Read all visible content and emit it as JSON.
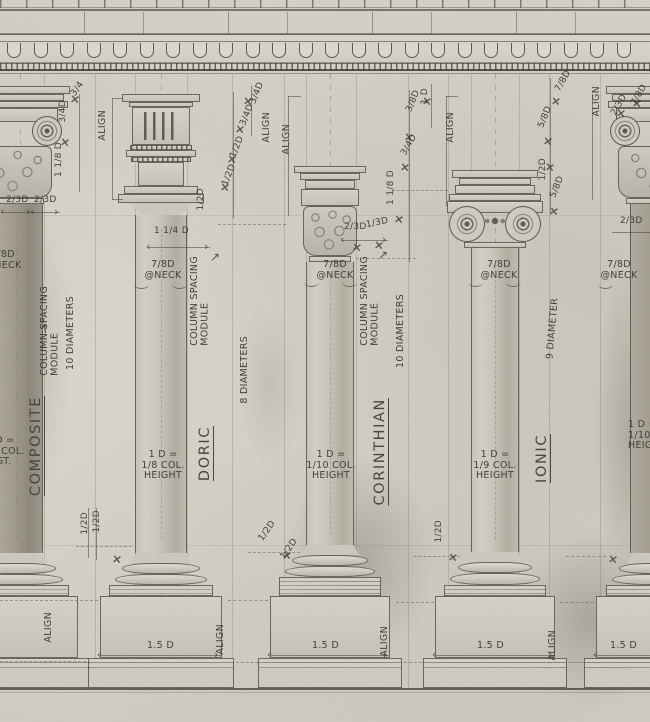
{
  "meta": {
    "subject": "Hand-drawn classical column orders elevation"
  },
  "colors": {
    "paper": "#d4d1c7",
    "ink": "#4a463e",
    "pencil": "#6a655a"
  },
  "orders": {
    "composite": {
      "name": "COMPOSITE",
      "module": "COLUMN SPACING\nMODULE",
      "diameters": "10 DIAMETERS",
      "neck": "7/8D\n@NECK",
      "height_rule": "1 D =\n1/10 COL.\nHGT."
    },
    "doric": {
      "name": "DORIC",
      "module": "COLUMN SPACING\nMODULE",
      "diameters": "8 DIAMETERS",
      "neck": "7/8D\n@NECK",
      "height_rule": "1 D =\n1/8 COL.\nHEIGHT",
      "base_width": "1.5 D"
    },
    "corinthian": {
      "name": "CORINTHIAN",
      "module": "COLUMN SPACING\nMODULE",
      "diameters": "10 DIAMETERS",
      "neck": "7/8D\n@NECK",
      "height_rule": "1 D =\n1/10 COL.\nHEIGHT",
      "base_width": "1.5 D"
    },
    "ionic": {
      "name": "IONIC",
      "diameters": "9 DIAMETER",
      "neck": "7/8D\n@NECK",
      "height_rule": "1 D =\n1/9 COL.\nHEIGHT",
      "base_width": "1.5 D"
    },
    "right_partial": {
      "neck": "7/8D\n@NECK",
      "height_rule": "1 D =\n1/10 COL.\nHEIGHT",
      "base_width": "1.5 D"
    }
  },
  "dims": {
    "c34": "3/4",
    "c34d": "3/4D",
    "c118d": "1 1/8 D",
    "c23a": "2/3D",
    "c23b": "2/3D",
    "c12d": "1/2D",
    "d34a": "3/4D",
    "d34b": "3/4D",
    "d12a": "1/2D",
    "d12b": "1/2D",
    "d114": "1 1/4 D",
    "d12c": "1/2D",
    "d12base": "1/2D",
    "k38": "3/8D",
    "k1d": "1 D",
    "k34": "3/4D",
    "k118": "1 1/8 D",
    "k23": "2/3D",
    "k13": "1/3D",
    "k12a": "1/2D",
    "k12b": "1/2D",
    "i78": "7/8D",
    "i58a": "5/8D",
    "i12": "1/2D",
    "i58b": "5/8D",
    "i12base": "1/2D",
    "r78": "7/8D",
    "r23": "2/3D",
    "r23b": "2/3D"
  },
  "align_label": "ALIGN"
}
